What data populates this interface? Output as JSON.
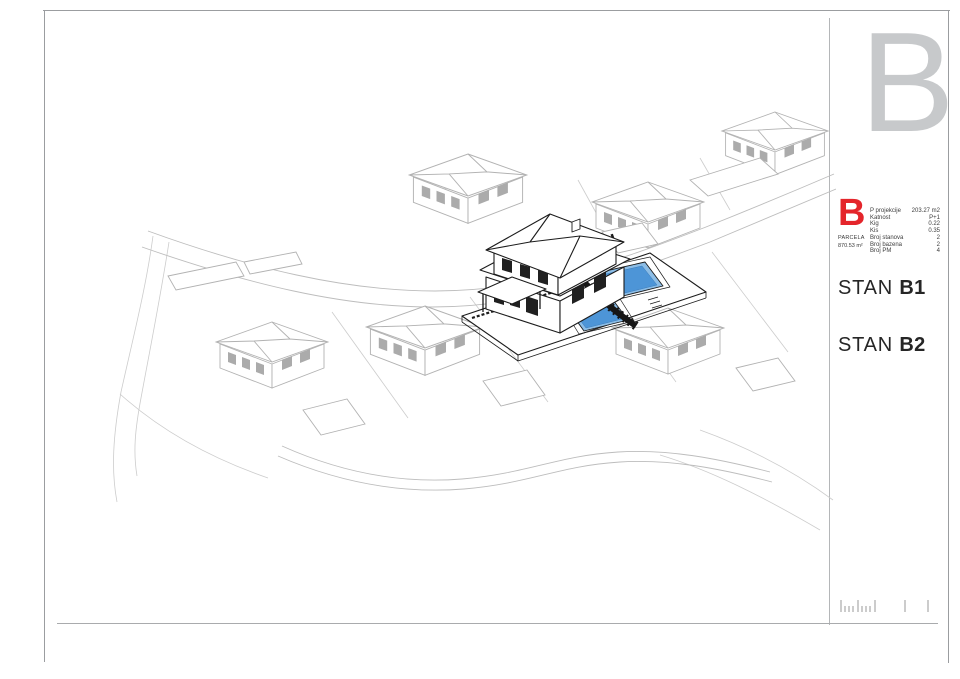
{
  "sheet": {
    "corner_letter": "B"
  },
  "info_panel": {
    "block_letter": "B",
    "parcel_label": "PARCELA",
    "parcel_area": "870.53 m²",
    "table": {
      "rows": [
        {
          "label": "P projekcije",
          "value": "203.27 m2"
        },
        {
          "label": "Katnost",
          "value": "P+1"
        },
        {
          "label": "Kig",
          "value": "0.22"
        },
        {
          "label": "Kis",
          "value": "0.35"
        },
        {
          "label": "Broj stanova",
          "value": "2"
        },
        {
          "label": "Broj bazena",
          "value": "2"
        },
        {
          "label": "Broj PM",
          "value": "4"
        }
      ]
    },
    "units": [
      {
        "prefix": "STAN ",
        "name": "B1"
      },
      {
        "prefix": "STAN ",
        "name": "B2"
      }
    ]
  },
  "drawing": {
    "type": "axonometric-site-plan",
    "highlighted_building": "B",
    "pools_highlighted": 2,
    "colors": {
      "accent_red": "#e4252b",
      "pool_water": "#4d95d7",
      "pool_rim": "#8cbde6",
      "dark_lines": "#1c1c1c",
      "light_lines": "#b2b2b2",
      "corner_letter_gray": "#c7c9cb"
    }
  }
}
